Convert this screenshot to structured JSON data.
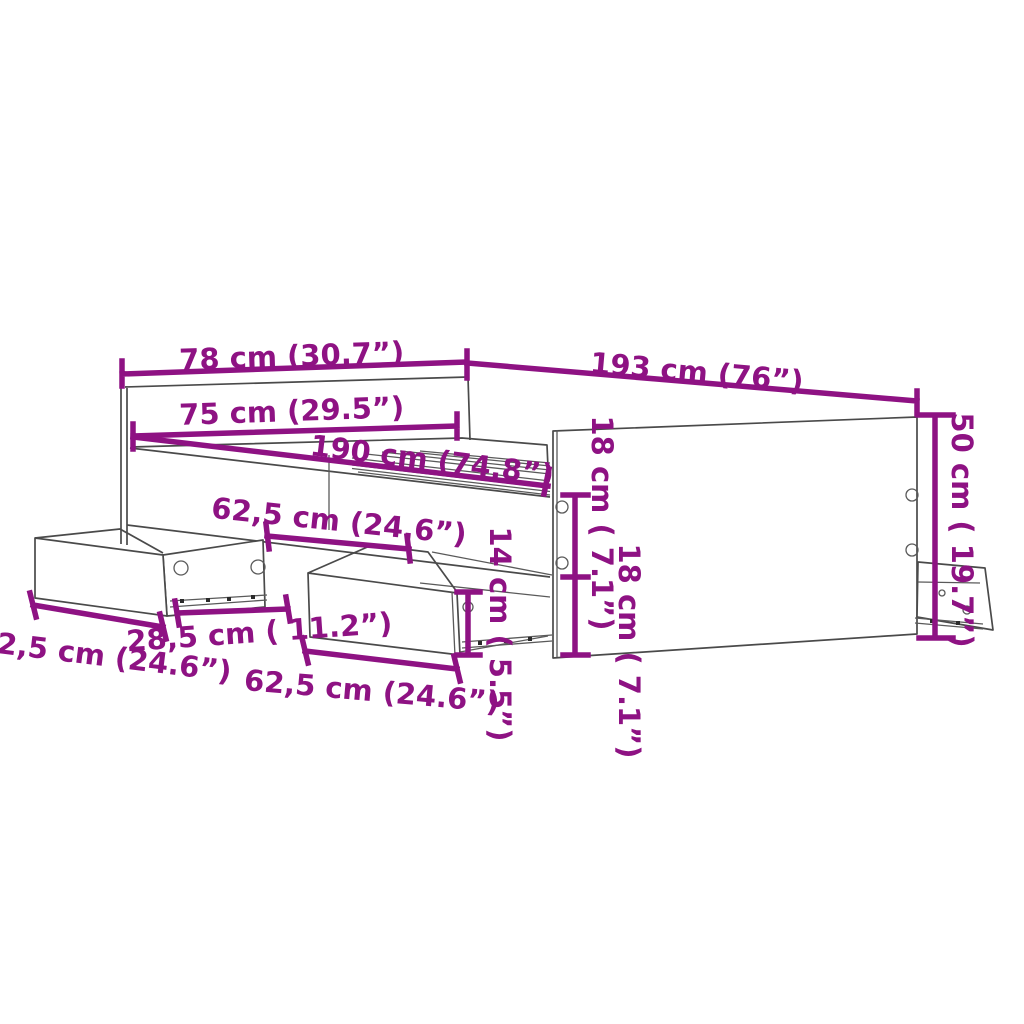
{
  "diagram": {
    "type": "furniture-dimension-diagram",
    "subject": "bed frame with storage drawers",
    "colors": {
      "dimension_annotation": "#8E1283",
      "outline": "#4a4a4a",
      "background": "#ffffff"
    },
    "dimension_labels": {
      "headboard_width": "78 cm (30.7”)",
      "frame_length": "193 cm (76”)",
      "inner_width": "75 cm (29.5”)",
      "inner_length": "190 cm (74.8”)",
      "rail_drawer_width": "62,5 cm (24.6”)",
      "left_drawer_width": "62,5 cm (24.6”)",
      "drawer_depth": "28,5 cm ( 11.2”)",
      "center_drawer_width": "62,5 cm (24.6”)",
      "drawer_front_height": "14 cm ( 5.5”)",
      "clearance_upper": "18 cm ( 7.1”)",
      "clearance_lower": "18 cm ( 7.1”)",
      "footboard_height": "50 cm ( 19.7”)"
    }
  }
}
